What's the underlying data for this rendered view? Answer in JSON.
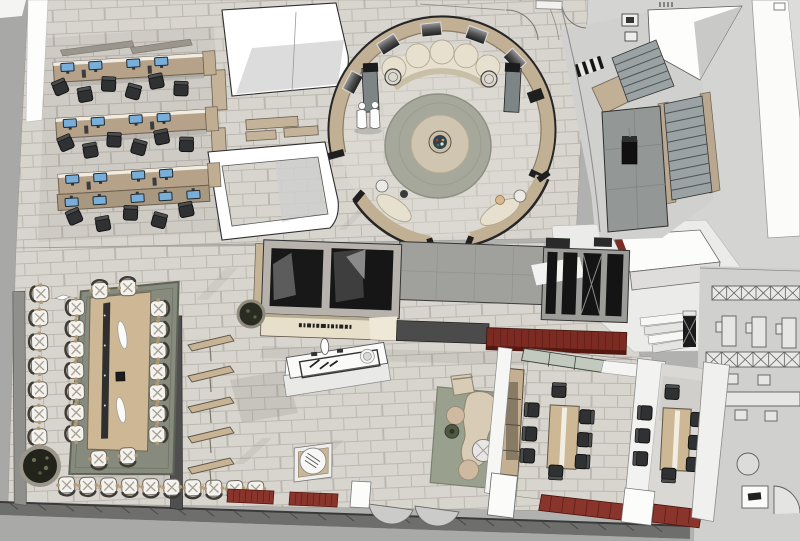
{
  "scene": {
    "title": "Office interior 3D floor-plan render",
    "render_style": "top-down axonometric architectural rendering",
    "legible_text": "none",
    "reception_fascia": {
      "logo_mark": "small dark wordmark, illegible at this scale"
    },
    "people": {
      "standing": 2,
      "seated": 2
    },
    "areas": {
      "workstations": {
        "label": "Open office workstation rows",
        "desk_rows": 4,
        "monitors_per_row": 4
      },
      "circular_lounge": {
        "label": "Circular lounge with curved partition walls",
        "wall_art_panels": 5
      },
      "conference_room": {
        "label": "Board room with long conference table",
        "table_seats": 18,
        "wall_seats": 18
      },
      "reception_block": {
        "label": "Reception counter block with enclosed dark rooms"
      },
      "meeting_room_1": {
        "label": "Meeting room 1",
        "seats": 8
      },
      "meeting_room_2": {
        "label": "Meeting room 2",
        "seats": 8
      },
      "staircase": {
        "label": "Staircase with concrete landing"
      },
      "corridor": {
        "label": "White corridor / circulation zone"
      },
      "lounge_corner": {
        "label": "Soft seating corner with rug and poufs"
      },
      "pantry_island": {
        "label": "Marble counter island"
      },
      "display_shelves": {
        "label": "Angled display shelves",
        "count": 5
      },
      "wireframe_zone": {
        "label": "Unrendered wireframe furniture zone"
      }
    },
    "palette": {
      "floor_tile": "#d8d5cf",
      "tile_joint": "#bcb8b1",
      "exterior_gray": "#a8a8a6",
      "wall_white": "#fcfcfa",
      "wood_light": "#c8b494",
      "desk_tan": "#b5a289",
      "rug_conference": "#878b7d",
      "rug_circle": "#a6a89b",
      "rug_lounge": "#99a08d",
      "bench_red": "#8a352c",
      "wall_red": "#7c2b23",
      "panel_dark": "#1b1b1b",
      "chair_dark": "#303132",
      "chair_white": "#f3f2ee",
      "concrete": "#a0a09c",
      "stair_tread": "#9aa2a4",
      "monitor_blue": "#79aed9",
      "sofa_cream": "#e8e0cf"
    }
  }
}
